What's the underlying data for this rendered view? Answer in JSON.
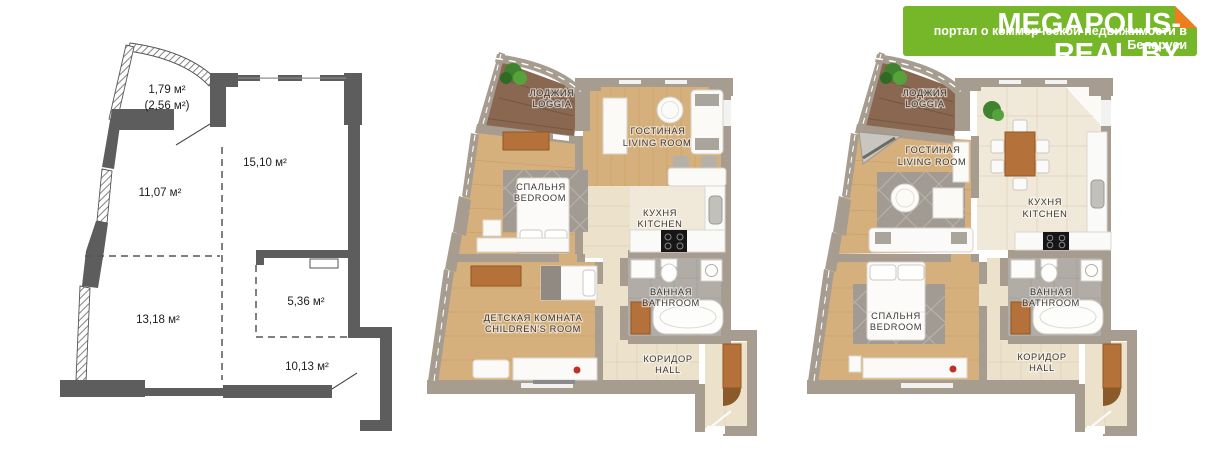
{
  "logo": {
    "title": "MEGAPOLIS-REAL.BY",
    "tagline": "портал о коммерческой недвижимости в Беларуси",
    "colors": {
      "background": "#76b72a",
      "fold": "#ee7d1e",
      "text": "#ffffff"
    }
  },
  "schematic_plan": {
    "description": "dimensioned floor plan with room areas",
    "areas": {
      "loggia": "1,79 м²",
      "loggia_total": "(2,56 м²)",
      "room_top_right": "15,10 м²",
      "room_mid_left": "11,07 м²",
      "room_bottom_left": "13,18 м²",
      "bathroom": "5,36 м²",
      "hall": "10,13 м²"
    }
  },
  "furnished_plan_1": {
    "description": "furnished layout option 1",
    "rooms": {
      "loggia": {
        "ru": "ЛОДЖИЯ",
        "en": "LOGGIA"
      },
      "living": {
        "ru": "ГОСТИНАЯ",
        "en": "LIVING ROOM"
      },
      "bedroom": {
        "ru": "СПАЛЬНЯ",
        "en": "BEDROOM"
      },
      "kitchen": {
        "ru": "КУХНЯ",
        "en": "KITCHEN"
      },
      "children": {
        "ru": "ДЕТСКАЯ КОМНАТА",
        "en": "CHILDREN'S ROOM"
      },
      "bathroom": {
        "ru": "ВАННАЯ",
        "en": "BATHROOM"
      },
      "hall": {
        "ru": "КОРИДОР",
        "en": "HALL"
      }
    }
  },
  "furnished_plan_2": {
    "description": "furnished layout option 2",
    "rooms": {
      "loggia": {
        "ru": "ЛОДЖИЯ",
        "en": "LOGGIA"
      },
      "living": {
        "ru": "ГОСТИНАЯ",
        "en": "LIVING ROOM"
      },
      "kitchen": {
        "ru": "КУХНЯ",
        "en": "KITCHEN"
      },
      "bedroom": {
        "ru": "СПАЛЬНЯ",
        "en": "BEDROOM"
      },
      "bathroom": {
        "ru": "ВАННАЯ",
        "en": "BATHROOM"
      },
      "hall": {
        "ru": "КОРИДОР",
        "en": "HALL"
      }
    }
  },
  "palette": {
    "schematic_wall": "#5d5d5d",
    "furnished_wall": "#a69c90",
    "wood_light": "#d6b07c",
    "wood_dark_loggia": "#8a6750",
    "tile_beige": "#ece1cb",
    "tile_gray": "#b1ada6",
    "furniture_wood": "#b5713a",
    "rug_gray": "#a19b94",
    "stove_black": "#161616",
    "plant_green": "#3f8230",
    "accent_red": "#c03028"
  }
}
